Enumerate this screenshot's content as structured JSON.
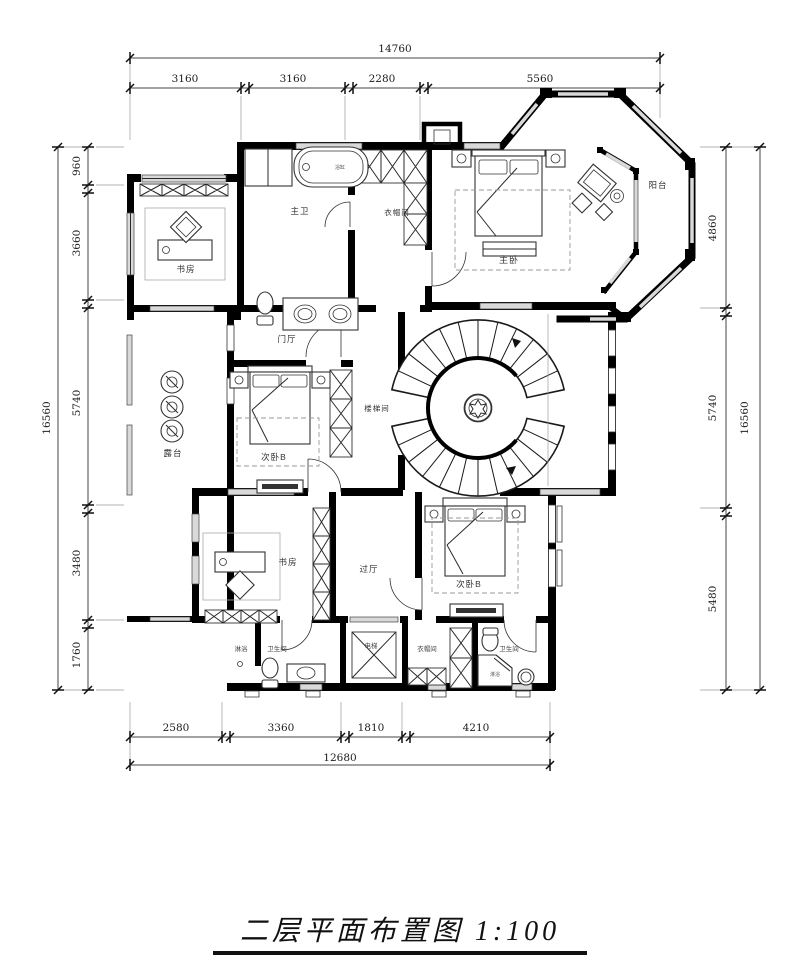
{
  "title": "二层平面布置图 1:100",
  "dims": {
    "top": {
      "total": "14760",
      "segs": [
        "3160",
        "3160",
        "2280",
        "5560"
      ]
    },
    "left": {
      "total": "16560",
      "segs": [
        "960",
        "3660",
        "5740",
        "3480",
        "1760"
      ]
    },
    "right": {
      "total": "16560",
      "segs": [
        "4860",
        "5740",
        "5480"
      ]
    },
    "bottom": {
      "total": "12680",
      "segs": [
        "2580",
        "3360",
        "1810",
        "4210"
      ]
    }
  },
  "rooms": {
    "master_bath": "主卫",
    "cloakroom_top": "衣帽间",
    "master_bedroom": "主卧",
    "balcony": "阳台",
    "study_top": "书房",
    "foyer": "门厅",
    "stair_hall": "楼梯间",
    "bedroom_b_mid": "次卧B",
    "terrace": "露台",
    "study_bottom": "书房",
    "hallway": "过厅",
    "bedroom_b_bottom": "次卧B",
    "shower_left": "淋浴",
    "bath_left": "卫生间",
    "elevator": "电梯",
    "cloakroom_bottom": "衣帽间",
    "bath_right": "卫生间",
    "shower_right": "淋浴",
    "bathtub": "浴缸"
  },
  "colors": {
    "wall": "#000000",
    "line": "#2a2a2a",
    "window_fill": "#d9d9d9",
    "label": "#333333"
  }
}
